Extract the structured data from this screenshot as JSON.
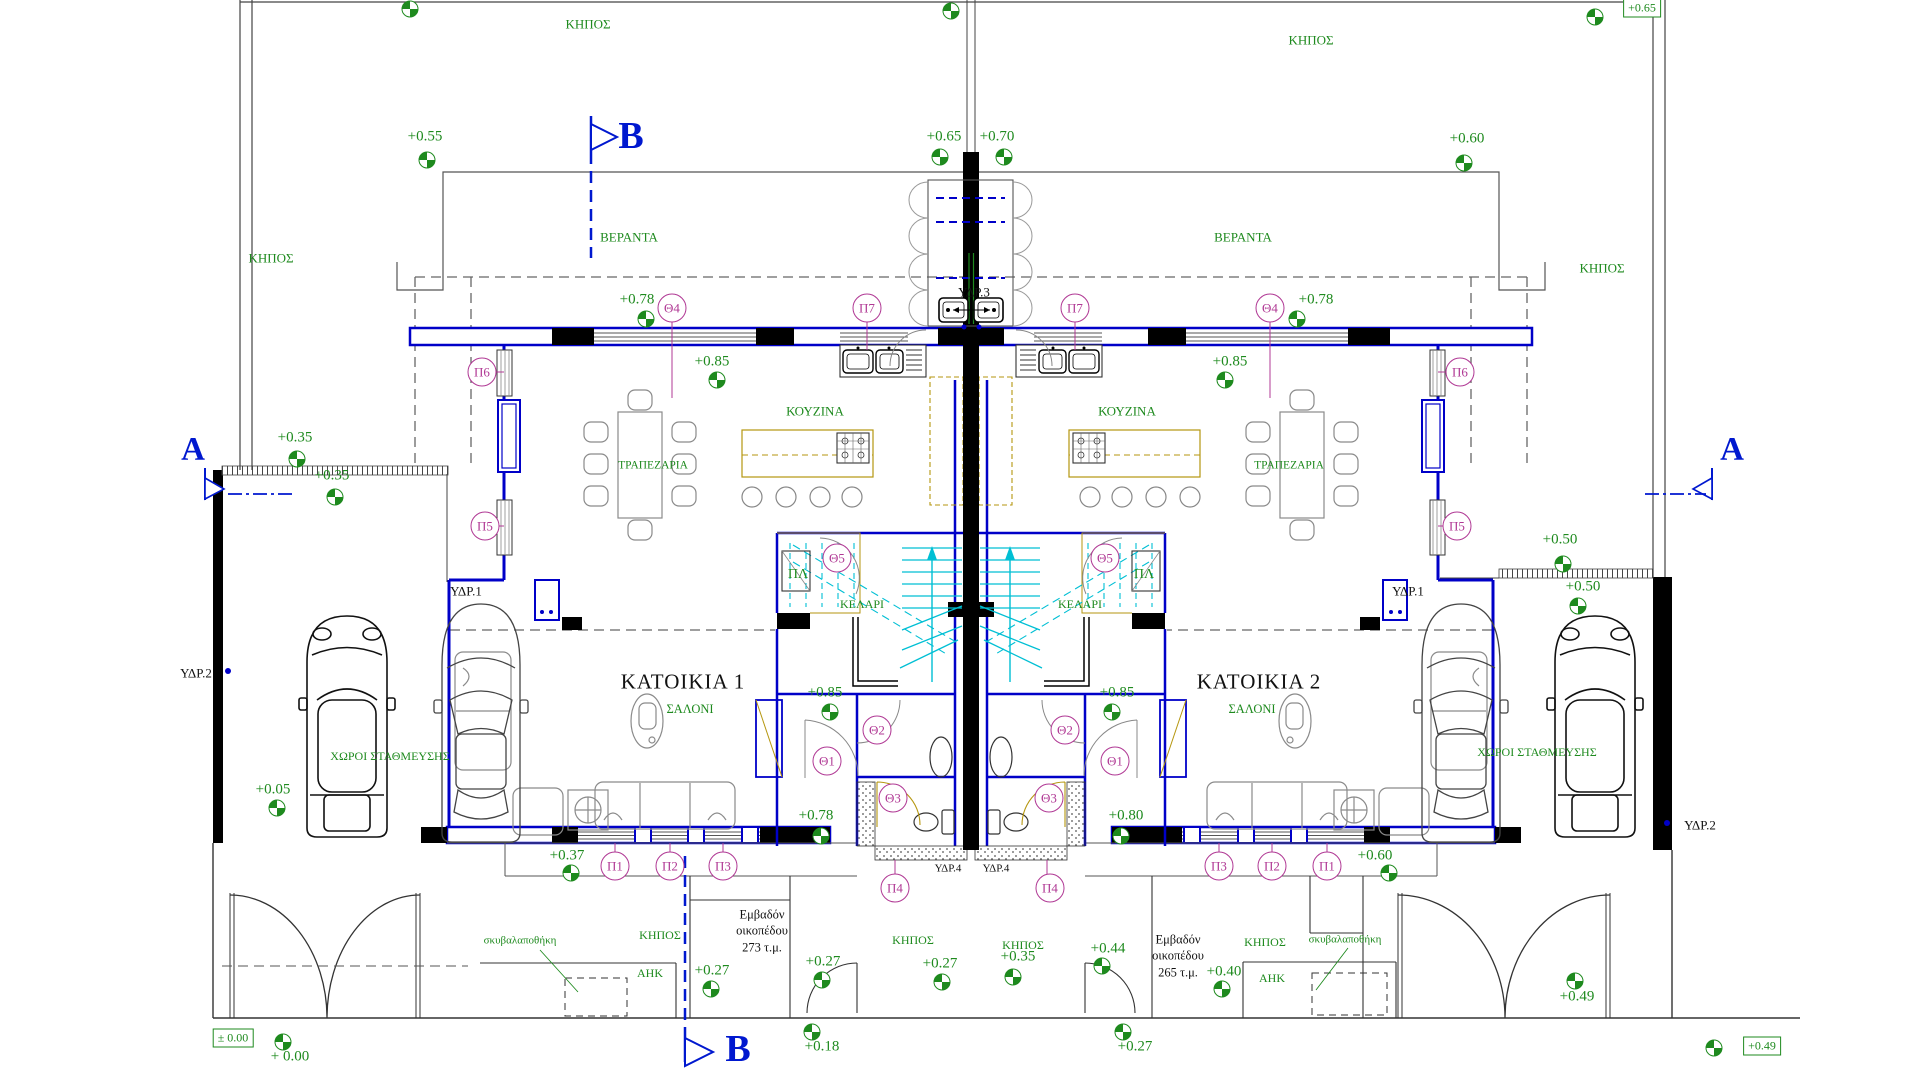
{
  "colors": {
    "wall_blue": "#0000c8",
    "section_blue": "#0018cf",
    "annotation_green": "#1e8a1e",
    "tag_magenta": "#b03894",
    "stair_cyan": "#00bfd4",
    "counter_olive": "#b5960f"
  },
  "houses": [
    {
      "name": "ΚΑΤΟΙΚΙΑ 1",
      "p": [
        683,
        682
      ]
    },
    {
      "name": "ΚΑΤΟΙΚΙΑ 2",
      "p": [
        1259,
        682
      ]
    }
  ],
  "area_notes": [
    {
      "lines": [
        "Εμβαδόν",
        "οικοπέδου",
        "273 τ.μ."
      ],
      "p": [
        762,
        931
      ]
    },
    {
      "lines": [
        "Εμβαδόν",
        "οικοπέδου",
        "265 τ.μ."
      ],
      "p": [
        1178,
        956
      ]
    }
  ],
  "room_labels": [
    {
      "t": "ΚΗΠΟΣ",
      "p": [
        588,
        24
      ]
    },
    {
      "t": "ΚΗΠΟΣ",
      "p": [
        1311,
        40
      ]
    },
    {
      "t": "ΚΗΠΟΣ",
      "p": [
        271,
        258
      ]
    },
    {
      "t": "ΚΗΠΟΣ",
      "p": [
        1602,
        268
      ]
    },
    {
      "t": "ΒΕΡΑΝΤΑ",
      "p": [
        629,
        237
      ]
    },
    {
      "t": "ΒΕΡΑΝΤΑ",
      "p": [
        1243,
        237
      ]
    },
    {
      "t": "ΤΡΑΠΕΖΑΡΙΑ",
      "p": [
        653,
        466
      ],
      "s": 11.5
    },
    {
      "t": "ΤΡΑΠΕΖΑΡΙΑ",
      "p": [
        1289,
        466
      ],
      "s": 11.5
    },
    {
      "t": "ΚΟΥΖΙΝΑ",
      "p": [
        815,
        411
      ]
    },
    {
      "t": "ΚΟΥΖΙΝΑ",
      "p": [
        1127,
        411
      ]
    },
    {
      "t": "ΠΛ",
      "p": [
        798,
        575
      ],
      "s": 14
    },
    {
      "t": "ΠΛ",
      "p": [
        1144,
        575
      ],
      "s": 14
    },
    {
      "t": "ΚΕΛΑΡΙ",
      "p": [
        862,
        604
      ],
      "s": 12
    },
    {
      "t": "ΚΕΛΑΡΙ",
      "p": [
        1080,
        604
      ],
      "s": 12
    },
    {
      "t": "ΣΑΛΟΝΙ",
      "p": [
        690,
        709
      ],
      "s": 12.5
    },
    {
      "t": "ΣΑΛΟΝΙ",
      "p": [
        1252,
        709
      ],
      "s": 12.5
    },
    {
      "t": "ΧΩΡΟΙ ΣΤΑΘΜΕΥΣΗΣ",
      "p": [
        390,
        756
      ],
      "s": 12
    },
    {
      "t": "ΧΩΡΟΙ ΣΤΑΘΜΕΥΣΗΣ",
      "p": [
        1537,
        752
      ],
      "s": 12
    },
    {
      "t": "ΚΗΠΟΣ",
      "p": [
        660,
        935
      ],
      "s": 12
    },
    {
      "t": "ΚΗΠΟΣ",
      "p": [
        913,
        940
      ],
      "s": 12
    },
    {
      "t": "ΚΗΠΟΣ",
      "p": [
        1023,
        945
      ],
      "s": 12
    },
    {
      "t": "ΚΗΠΟΣ",
      "p": [
        1265,
        942
      ],
      "s": 12
    },
    {
      "t": "ΑΗΚ",
      "p": [
        650,
        973
      ],
      "s": 12
    },
    {
      "t": "ΑΗΚ",
      "p": [
        1272,
        978
      ],
      "s": 12
    },
    {
      "t": "σκυβαλαποθήκη",
      "p": [
        520,
        941
      ],
      "s": 11
    },
    {
      "t": "σκυβαλαποθήκη",
      "p": [
        1345,
        940
      ],
      "s": 11
    }
  ],
  "utility_labels": [
    {
      "t": "ΥΔΡ.3",
      "p": [
        974,
        292
      ],
      "s": 13
    },
    {
      "t": "ΥΔΡ.1",
      "p": [
        466,
        591
      ],
      "s": 13
    },
    {
      "t": "ΥΔΡ.1",
      "p": [
        1408,
        591
      ],
      "s": 13
    },
    {
      "t": "ΥΔΡ.2",
      "p": [
        196,
        673
      ],
      "s": 13
    },
    {
      "t": "ΥΔΡ.2",
      "p": [
        1700,
        825
      ],
      "s": 13
    },
    {
      "t": "ΥΔΡ.4",
      "p": [
        948,
        869
      ],
      "s": 11
    },
    {
      "t": "ΥΔΡ.4",
      "p": [
        996,
        869
      ],
      "s": 11
    }
  ],
  "tags": [
    {
      "t": "Π7",
      "p": [
        867,
        308
      ]
    },
    {
      "t": "Π7",
      "p": [
        1075,
        308
      ]
    },
    {
      "t": "Θ4",
      "p": [
        672,
        308
      ]
    },
    {
      "t": "Θ4",
      "p": [
        1270,
        308
      ]
    },
    {
      "t": "Π6",
      "p": [
        482,
        372
      ]
    },
    {
      "t": "Π6",
      "p": [
        1460,
        372
      ]
    },
    {
      "t": "Π5",
      "p": [
        485,
        526
      ]
    },
    {
      "t": "Π5",
      "p": [
        1457,
        526
      ]
    },
    {
      "t": "Θ5",
      "p": [
        837,
        558
      ]
    },
    {
      "t": "Θ5",
      "p": [
        1105,
        558
      ]
    },
    {
      "t": "Θ2",
      "p": [
        877,
        730
      ]
    },
    {
      "t": "Θ2",
      "p": [
        1065,
        730
      ]
    },
    {
      "t": "Θ1",
      "p": [
        827,
        761
      ]
    },
    {
      "t": "Θ1",
      "p": [
        1115,
        761
      ]
    },
    {
      "t": "Θ3",
      "p": [
        893,
        798
      ]
    },
    {
      "t": "Θ3",
      "p": [
        1049,
        798
      ]
    },
    {
      "t": "Π1",
      "p": [
        615,
        866
      ]
    },
    {
      "t": "Π2",
      "p": [
        670,
        866
      ]
    },
    {
      "t": "Π3",
      "p": [
        723,
        866
      ]
    },
    {
      "t": "Π3",
      "p": [
        1219,
        866
      ]
    },
    {
      "t": "Π2",
      "p": [
        1272,
        866
      ]
    },
    {
      "t": "Π1",
      "p": [
        1327,
        866
      ]
    },
    {
      "t": "Π4",
      "p": [
        895,
        888
      ]
    },
    {
      "t": "Π4",
      "p": [
        1050,
        888
      ]
    }
  ],
  "elevations": [
    {
      "v": "+0.55",
      "t": [
        425,
        137
      ],
      "m": [
        427,
        160
      ]
    },
    {
      "v": "+0.65",
      "t": [
        944,
        137
      ],
      "m": [
        940,
        157
      ]
    },
    {
      "v": "+0.70",
      "t": [
        997,
        137
      ],
      "m": [
        1004,
        157
      ]
    },
    {
      "v": "+0.60",
      "t": [
        1467,
        139
      ],
      "m": [
        1464,
        163
      ]
    },
    {
      "v": "+0.78",
      "t": [
        637,
        300
      ],
      "m": [
        646,
        319
      ]
    },
    {
      "v": "+0.78",
      "t": [
        1316,
        300
      ],
      "m": [
        1297,
        319
      ]
    },
    {
      "v": "+0.85",
      "t": [
        712,
        362
      ],
      "m": [
        717,
        380
      ]
    },
    {
      "v": "+0.85",
      "t": [
        1230,
        362
      ],
      "m": [
        1225,
        380
      ]
    },
    {
      "v": "+0.35",
      "t": [
        295,
        438
      ],
      "m": [
        297,
        459
      ]
    },
    {
      "v": "+0.35",
      "t": [
        332,
        476
      ],
      "m": [
        335,
        497
      ]
    },
    {
      "v": "+0.50",
      "t": [
        1560,
        540
      ],
      "m": [
        1563,
        564
      ]
    },
    {
      "v": "+0.50",
      "t": [
        1583,
        587
      ],
      "m": [
        1578,
        606
      ]
    },
    {
      "v": "+0.85",
      "t": [
        825,
        693
      ],
      "m": [
        830,
        712
      ]
    },
    {
      "v": "+0.85",
      "t": [
        1117,
        693
      ],
      "m": [
        1112,
        712
      ]
    },
    {
      "v": "+0.78",
      "t": [
        816,
        816
      ],
      "m": [
        821,
        836
      ]
    },
    {
      "v": "+0.80",
      "t": [
        1126,
        816
      ],
      "m": [
        1121,
        836
      ]
    },
    {
      "v": "+0.37",
      "t": [
        567,
        856
      ],
      "m": [
        571,
        873
      ]
    },
    {
      "v": "+0.60",
      "t": [
        1375,
        856
      ],
      "m": [
        1389,
        873
      ]
    },
    {
      "v": "+0.05",
      "t": [
        273,
        790
      ],
      "m": [
        277,
        808
      ]
    },
    {
      "v": "+0.27",
      "t": [
        712,
        971
      ],
      "m": [
        711,
        989
      ]
    },
    {
      "v": "+0.27",
      "t": [
        823,
        962
      ],
      "m": [
        822,
        980
      ]
    },
    {
      "v": "+0.27",
      "t": [
        940,
        964
      ],
      "m": [
        942,
        982
      ]
    },
    {
      "v": "+0.35",
      "t": [
        1018,
        957
      ],
      "m": [
        1013,
        977
      ]
    },
    {
      "v": "+0.44",
      "t": [
        1108,
        949
      ],
      "m": [
        1102,
        966
      ]
    },
    {
      "v": "+0.40",
      "t": [
        1224,
        972
      ],
      "m": [
        1222,
        989
      ]
    },
    {
      "v": "+0.27",
      "t": [
        1135,
        1047
      ],
      "m": [
        1123,
        1032
      ]
    },
    {
      "v": "+0.18",
      "t": [
        822,
        1047
      ],
      "m": [
        812,
        1032
      ]
    },
    {
      "v": "+0.49",
      "t": [
        1577,
        997
      ],
      "m": [
        1575,
        981
      ]
    },
    {
      "v": "+ 0.00",
      "t": [
        290,
        1057
      ],
      "m": [
        283,
        1042
      ]
    }
  ],
  "markers_only": [
    [
      410,
      9
    ],
    [
      951,
      11
    ],
    [
      1595,
      17
    ],
    [
      1714,
      1048
    ]
  ],
  "level_boxes": [
    {
      "v": "± 0.00",
      "p": [
        233,
        1038
      ]
    },
    {
      "v": "+0.49",
      "p": [
        1762,
        1046
      ]
    },
    {
      "v": "+0.65",
      "p": [
        1642,
        8
      ]
    }
  ],
  "section_letters": [
    {
      "v": "Β",
      "p": [
        631,
        136
      ],
      "s": 38
    },
    {
      "v": "Β",
      "p": [
        738,
        1049
      ],
      "s": 38
    },
    {
      "v": "Α",
      "p": [
        193,
        450
      ],
      "s": 33
    },
    {
      "v": "Α",
      "p": [
        1732,
        450
      ],
      "s": 33
    }
  ]
}
